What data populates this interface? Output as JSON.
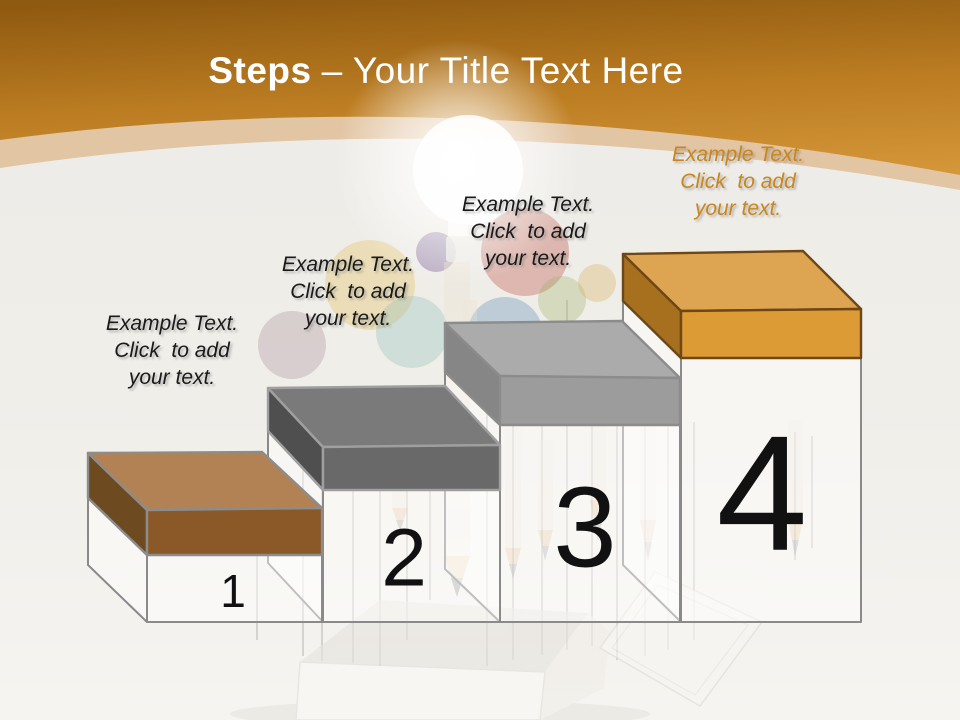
{
  "slide": {
    "title": {
      "bold": "Steps",
      "rest": "– Your Title Text Here",
      "color": "#FFFFFF"
    }
  },
  "header": {
    "gradient_top": "#8E5910",
    "gradient_mid": "#BC7D22",
    "gradient_bottom": "#D79A3C",
    "band_color": "#E2C5A3"
  },
  "boxes": {
    "body_fill": "rgba(255,255,255,0.45)",
    "body_stroke": "#8A8A8A",
    "number_color": "#111111"
  },
  "steps": [
    {
      "number": "1",
      "label": {
        "lines": [
          "Example Text.",
          "Click  to add",
          "your text."
        ],
        "color": "#1A1A1A"
      },
      "slab": {
        "top": "#B28254",
        "front": "#8B5827",
        "side": "#6E4A20",
        "outline": "#8C8C8C"
      }
    },
    {
      "number": "2",
      "label": {
        "lines": [
          "Example Text.",
          "Click  to add",
          "your text."
        ],
        "color": "#1A1A1A"
      },
      "slab": {
        "top": "#7A7A7A",
        "front": "#696969",
        "side": "#4F4F4F",
        "outline": "#9F9F9F"
      }
    },
    {
      "number": "3",
      "label": {
        "lines": [
          "Example Text.",
          "Click  to add",
          "your text."
        ],
        "color": "#1A1A1A"
      },
      "slab": {
        "top": "#ABABAB",
        "front": "#9C9C9C",
        "side": "#868686",
        "outline": "#8C8C8C"
      }
    },
    {
      "number": "4",
      "label": {
        "lines": [
          "Example Text.",
          "Click  to add",
          "your text."
        ],
        "color": "#C8861F"
      },
      "slab": {
        "top": "#DDA452",
        "front": "#DD9B35",
        "side": "#A6701F",
        "outline": "#6E4716"
      }
    }
  ],
  "scene": {
    "glow_color": "#FFFFFF",
    "bulb_colors": [
      "#E2BC55",
      "#A8909A",
      "#8FBFBC",
      "#5C3C80",
      "#B84A3C",
      "#4880B0",
      "#98B060",
      "#D8A850"
    ]
  }
}
